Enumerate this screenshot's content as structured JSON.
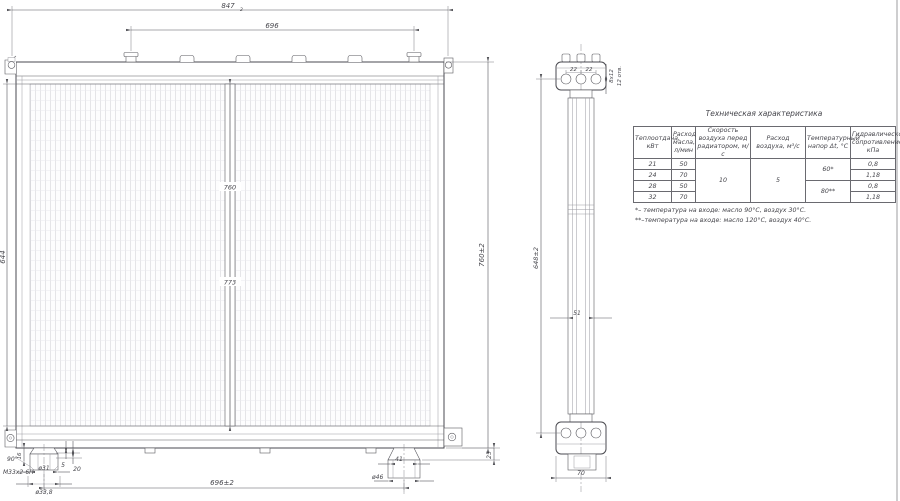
{
  "drawing": {
    "front_view": {
      "dim_width_total": "847",
      "dim_width_total_tol": "2",
      "dim_cap_span": "696",
      "dim_height_left": "644",
      "dim_height_right": "760±2",
      "dim_center_upper": "760",
      "dim_center_lower": "773",
      "dim_bottom_span": "696±2",
      "left_fitting": {
        "chamfer": "90°",
        "thread": "М33х2-6Н",
        "dia_1": "ø31",
        "dia_2": "ø33,8",
        "dim_a": "5",
        "dim_b": "20",
        "dim_c": "16"
      },
      "right_fitting": {
        "dim_width": "41",
        "dia": "ø46",
        "dim_offset": "25"
      }
    },
    "side_view": {
      "hole_pitch_1": "22",
      "hole_pitch_2": "22",
      "holes_size": "8х12",
      "holes_count": "12 отв.",
      "dim_height": "648±2",
      "dim_core_depth": "51",
      "dim_width": "70"
    }
  },
  "table": {
    "title": "Техническая характеристика",
    "headers": [
      "Теплоотдача, кВт",
      "Расход масла, л/мин",
      "Скорость воздуха перед радиатором, м/с",
      "Расход воздуха, м³/с",
      "Температурный напор Δt, °С",
      "Гидравлическое сопротивление, кПа"
    ],
    "air_speed": "10",
    "air_flow": "5",
    "temp_head_a": "60*",
    "temp_head_b": "80**",
    "rows": [
      {
        "power": "21",
        "oil_flow": "50",
        "resistance": "0,8"
      },
      {
        "power": "24",
        "oil_flow": "70",
        "resistance": "1,18"
      },
      {
        "power": "28",
        "oil_flow": "50",
        "resistance": "0,8"
      },
      {
        "power": "32",
        "oil_flow": "70",
        "resistance": "1,18"
      }
    ],
    "notes": [
      "*– температура на входе: масло 90°С, воздух 30°С.",
      "**–температура на входе: масло 120°С, воздух 40°С."
    ]
  }
}
